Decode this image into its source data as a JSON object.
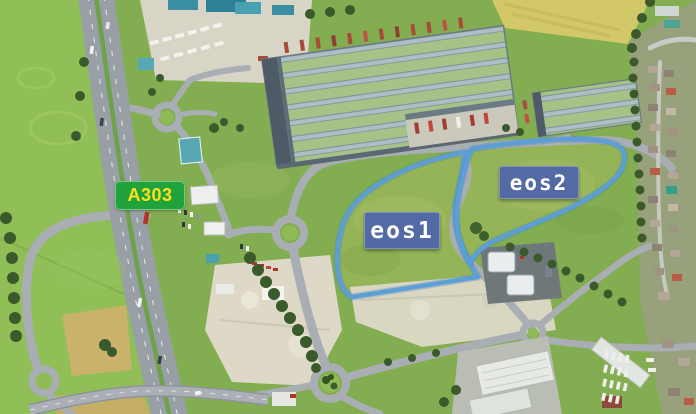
{
  "canvas": {
    "width": 696,
    "height": 414
  },
  "annotations": {
    "road_sign": {
      "text": "A303"
    },
    "plots": [
      {
        "id": "eos1",
        "label": "eos1"
      },
      {
        "id": "eos2",
        "label": "eos2"
      }
    ]
  },
  "colors": {
    "plot_outline": "#5c9ed6",
    "plot_outline_soft": "#4b86c2",
    "badge_bg": "rgba(72,94,176,0.87)",
    "badge_text": "#ffffff",
    "sign_bg": "#1fa33a",
    "sign_text": "#ffdf1e",
    "grass": "#86b254",
    "road": "#9aa1a8",
    "chalk": "#ddd9c6",
    "warehouse_roof_green": "#a6c287",
    "warehouse_roof_grey": "#adbec6",
    "tree": "#3b5a2b"
  }
}
